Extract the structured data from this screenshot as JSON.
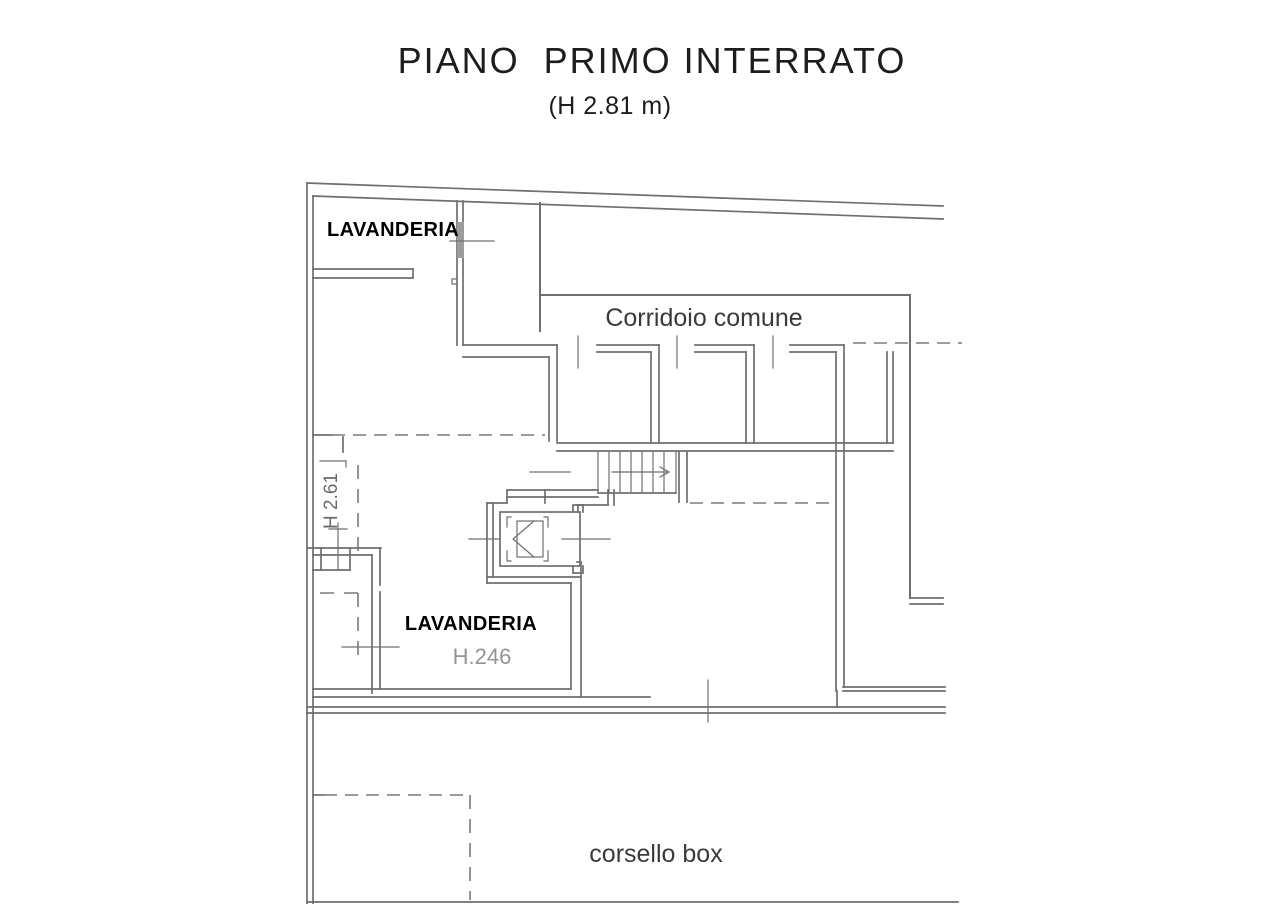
{
  "title": {
    "main": "PIANO  PRIMO INTERRATO",
    "height_note": "(H 2.81 m)"
  },
  "plan": {
    "labels": {
      "laundry_top": "LAVANDERIA",
      "corridor": "Corridoio comune",
      "height_261": "H 2.61",
      "laundry_main": "LAVANDERIA",
      "laundry_main_height": "H.246",
      "driveway": "corsello box"
    },
    "colors": {
      "background": "#ffffff",
      "wall_line": "#6f6f6f",
      "dashed_line": "#7a7a7a",
      "title_text": "#1d1d1d",
      "label_bold_text": "#000000",
      "label_mid_text": "#3a3a3a",
      "label_light_text": "#949494",
      "window_fill": "#9c9c9c"
    }
  }
}
